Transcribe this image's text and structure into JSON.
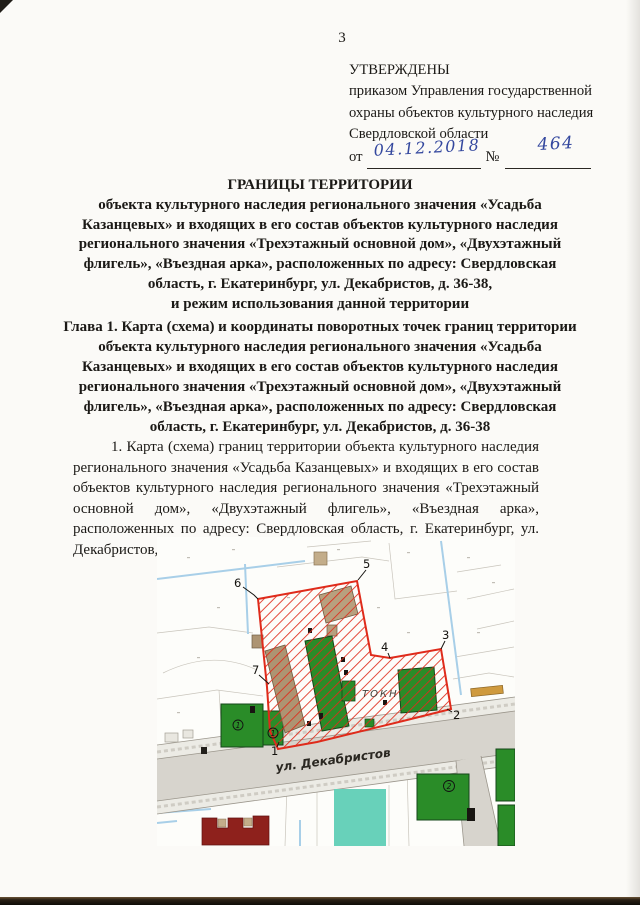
{
  "document": {
    "page_number": "3",
    "approval": {
      "title": "УТВЕРЖДЕНЫ",
      "lines": [
        "приказом Управления государственной",
        "охраны объектов культурного наследия",
        "Свердловской области"
      ],
      "from_label": "от",
      "date_value": "04.12.2018",
      "number_sign": "№",
      "number_value": "464"
    },
    "title_lines": [
      "ГРАНИЦЫ ТЕРРИТОРИИ",
      "объекта культурного наследия регионального значения «Усадьба",
      "Казанцевых» и входящих в его состав объектов культурного наследия",
      "регионального значения «Трехэтажный основной дом», «Двухэтажный",
      "флигель», «Въездная арка», расположенных по адресу: Свердловская",
      "область, г. Екатеринбург, ул. Декабристов, д. 36-38,",
      "и режим использования данной территории"
    ],
    "chapter_lines": [
      "Глава 1. Карта (схема) и координаты поворотных точек границ территории",
      "объекта культурного наследия регионального значения «Усадьба",
      "Казанцевых» и входящих в его состав объектов культурного наследия",
      "регионального значения «Трехэтажный основной дом», «Двухэтажный",
      "флигель», «Въездная арка», расположенных по адресу: Свердловская",
      "область, г. Екатеринбург, ул. Декабристов, д. 36-38"
    ],
    "paragraph": "1. Карта (схема) границ территории объекта культурного наследия регионального значения «Усадьба Казанцевых» и входящих в его состав объектов культурного наследия регионального значения «Трехэтажный основной дом», «Двухэтажный флигель», «Въездная арка», расположенных по адресу: Свердловская область, г. Екатеринбург, ул. Декабристов, д. 36-38 (далее – Объект):"
  },
  "map": {
    "street_label": "ул. Декабристов",
    "area_label": "ТОКН",
    "points": [
      "1",
      "2",
      "3",
      "4",
      "5",
      "6",
      "7"
    ],
    "building_marks": [
      "1",
      "1",
      "2"
    ],
    "colors": {
      "boundary_red": "#df2b1b",
      "building_green": "#2a8c28",
      "building_brown": "#ad9472",
      "historic_dark_red": "#8e211c",
      "water_blue": "#a8cfe8",
      "pond_teal": "#68d1ba",
      "road_gray": "#d7d4cd"
    }
  }
}
